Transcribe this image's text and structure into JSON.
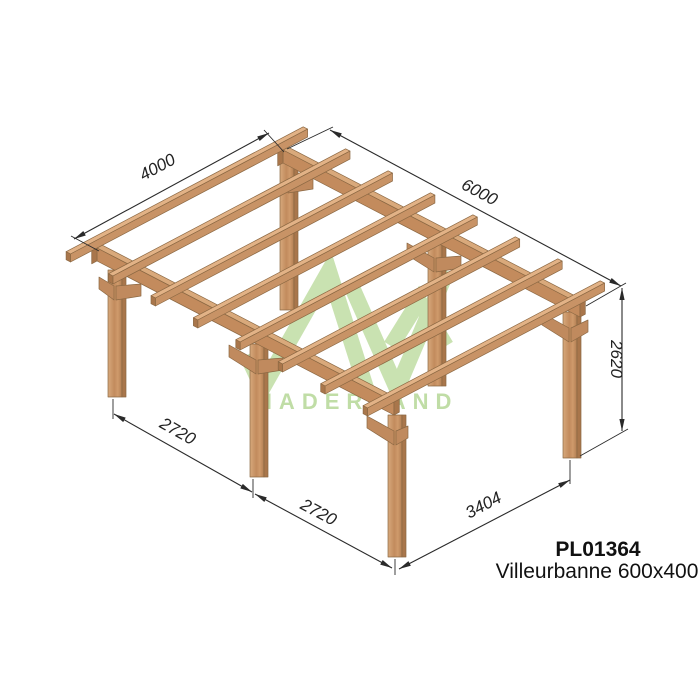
{
  "product": {
    "code": "PL01364",
    "name": "Villeurbanne 600x400"
  },
  "watermark": {
    "brand": "MADERLAND",
    "logo_icon": "mountains-mv-logo",
    "green": "#9ecb72"
  },
  "dimensions": {
    "top_left_width": "4000",
    "top_right_length": "6000",
    "right_height": "2620",
    "bottom_left_bay1": "2720",
    "bottom_left_bay2": "2720",
    "bottom_right_side": "3404"
  },
  "colors": {
    "wood_top_face": "#e2b286",
    "wood_front_face": "#c89366",
    "wood_end_grain": "#a9764b",
    "wood_outline": "#8b6843",
    "dimension_lines": "#2a2a2a",
    "background": "#ffffff"
  }
}
